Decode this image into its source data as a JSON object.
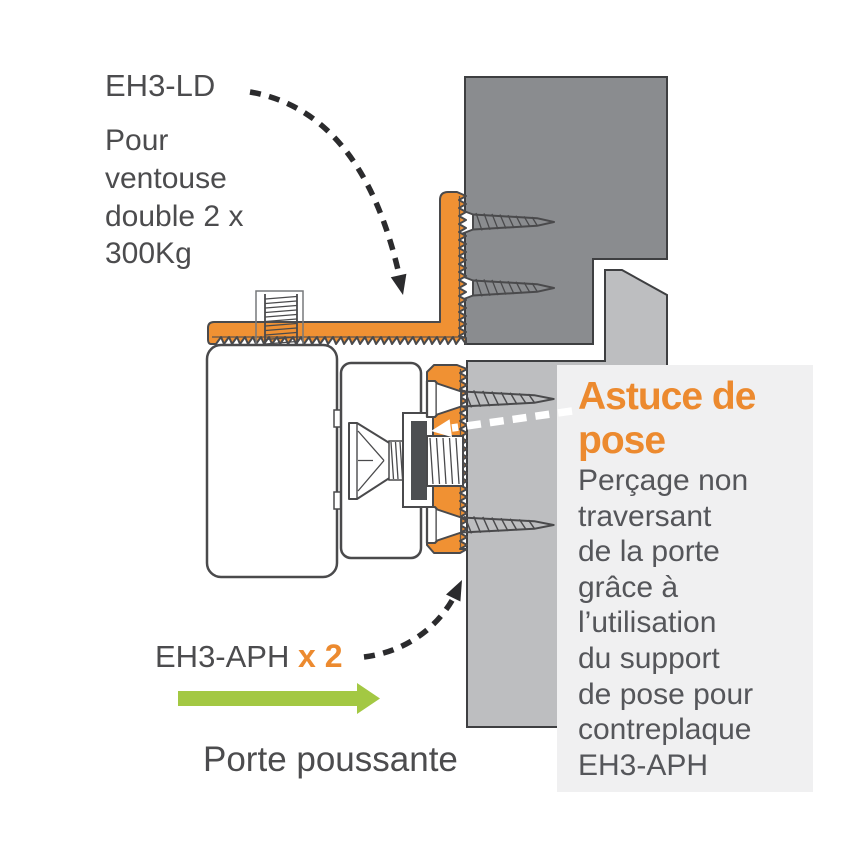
{
  "annotations": {
    "bracket_label": {
      "title": "EH3-LD",
      "description_lines": [
        "Pour",
        "ventouse",
        "double 2 x",
        "300Kg"
      ]
    },
    "support_label": {
      "product": "EH3-APH",
      "quantity": "x 2"
    },
    "door_label": "Porte poussante"
  },
  "callout": {
    "heading_lines": [
      "Astuce de",
      "pose"
    ],
    "body_lines": [
      "Perçage non",
      "traversant",
      "de la porte",
      "grâce à",
      "l’utilisation",
      "du support",
      "de pose pour",
      "contreplaque",
      "EH3-APH"
    ]
  },
  "colors": {
    "orange": "#F09133",
    "orange_text": "#EC8A2F",
    "frame_gray": "#8A8C8F",
    "door_gray": "#BDBEC0",
    "panel_gray": "#F0F0F1",
    "outline": "#4A4A4C",
    "text_dark": "#4C4C4E",
    "text_body": "#55565A",
    "green": "#A3C843",
    "washer_dark": "#4D4F52",
    "arrow_black": "#2B2B2D",
    "arrow_white": "#FFFFFF"
  },
  "icons": {
    "curved_dashed_arrow": "curved dashed pointer arrow",
    "green_direction_arrow": "solid right arrow",
    "white_callout_arrow": "white dashed left arrow",
    "wood_screw": "countersunk wood screw (side view)",
    "countersunk_bolt": "countersunk machine bolt (side view)"
  }
}
